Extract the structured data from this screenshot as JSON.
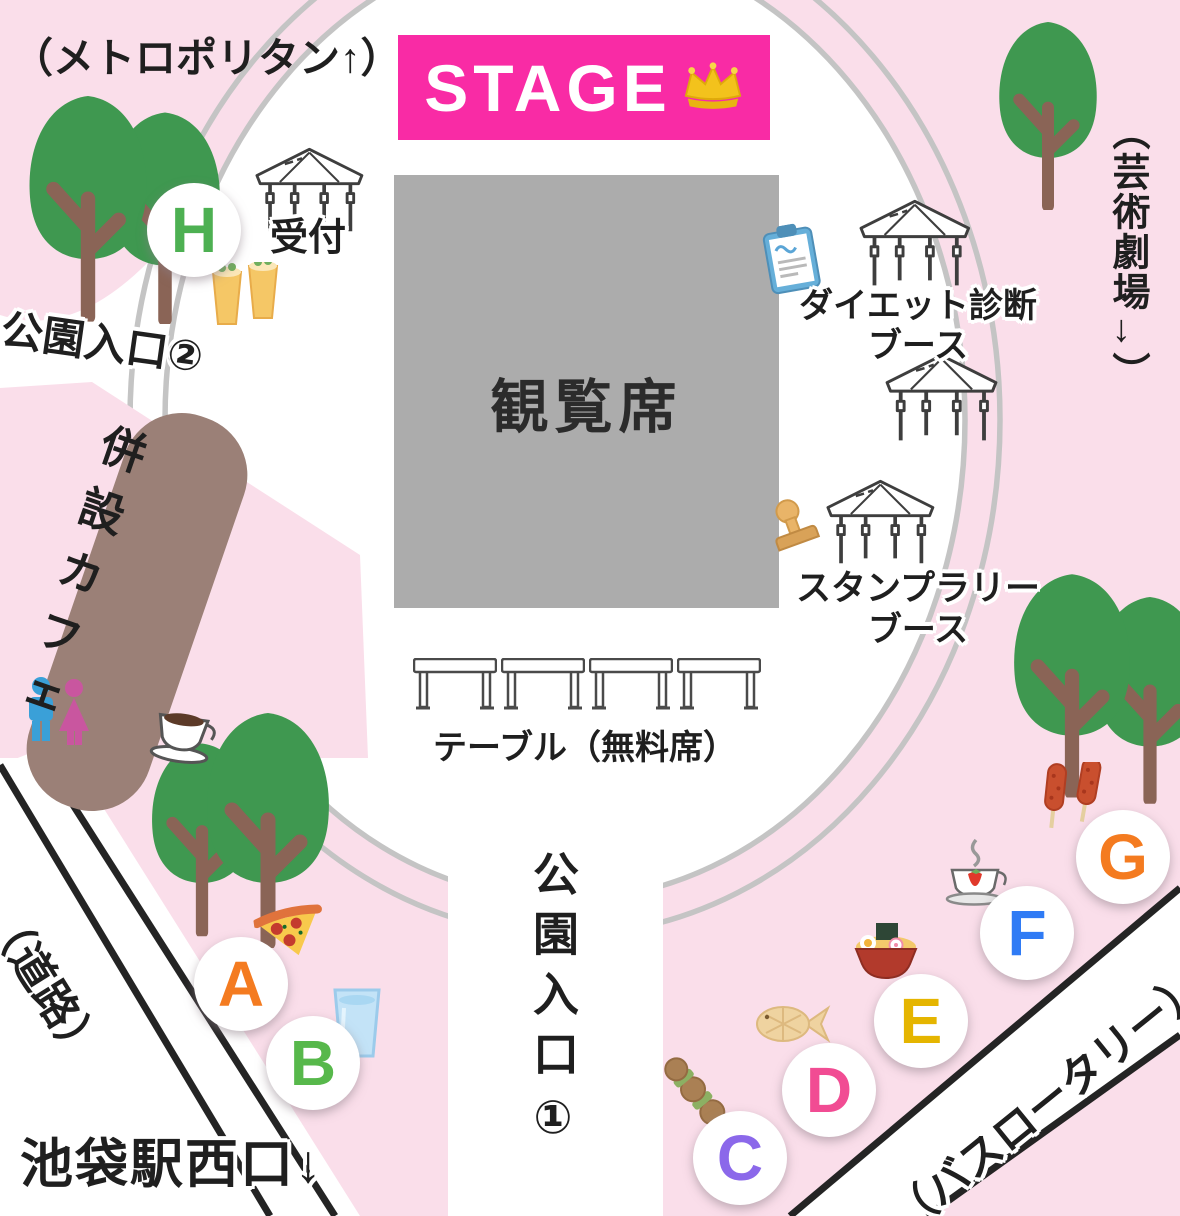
{
  "stage": {
    "label": "STAGE",
    "icon": "crown-icon"
  },
  "viewing_area": {
    "label": "観覧席"
  },
  "reception": {
    "label": "受付",
    "icon": "tent-icon"
  },
  "tables": {
    "label": "テーブル（無料席）"
  },
  "cafe": {
    "label": "併設カフェ",
    "icon": "coffee-cup-icon"
  },
  "booths": {
    "diet": {
      "line1": "ダイエット診断",
      "line2": "ブース",
      "icon": "clipboard-icon"
    },
    "stamp_rally": {
      "line1": "スタンプラリー",
      "line2": "ブース",
      "icon": "stamp-icon"
    }
  },
  "entrances": {
    "entrance1": "公園入口①",
    "entrance2": "公園入口②"
  },
  "landmarks": {
    "metropolitan": "（メトロポリタン↑）",
    "art_theater": "（芸術劇場→）",
    "station_west_exit": "池袋駅西口↓",
    "road": "（道路）",
    "bus_rotary": "（バスロータリー）"
  },
  "stalls": [
    {
      "letter": "A",
      "color": "#F47B20",
      "food": "pizza"
    },
    {
      "letter": "B",
      "color": "#57B84B",
      "food": "water-glass"
    },
    {
      "letter": "C",
      "color": "#8B68EA",
      "food": "yakitori-skewer"
    },
    {
      "letter": "D",
      "color": "#F14C93",
      "food": "taiyaki"
    },
    {
      "letter": "E",
      "color": "#E5B500",
      "food": "ramen"
    },
    {
      "letter": "F",
      "color": "#2F7BF5",
      "food": "strawberry-tea"
    },
    {
      "letter": "G",
      "color": "#F47B20",
      "food": "corn-dogs"
    },
    {
      "letter": "H",
      "color": "#4DB052",
      "food": "beer"
    }
  ],
  "colors": {
    "background_pink": "#FADEEA",
    "plaza_white": "#FFFFFF",
    "stage_pink": "#F92BA5",
    "seating_gray": "#ACACAC",
    "cafe_brown": "#9B8077",
    "tree_green": "#3F9850",
    "trunk_brown": "#8A6456",
    "ring_gray": "#C4C4C4",
    "road_line_black": "#242424",
    "restroom_male": "#3AA0D8",
    "restroom_female": "#C9569F"
  }
}
